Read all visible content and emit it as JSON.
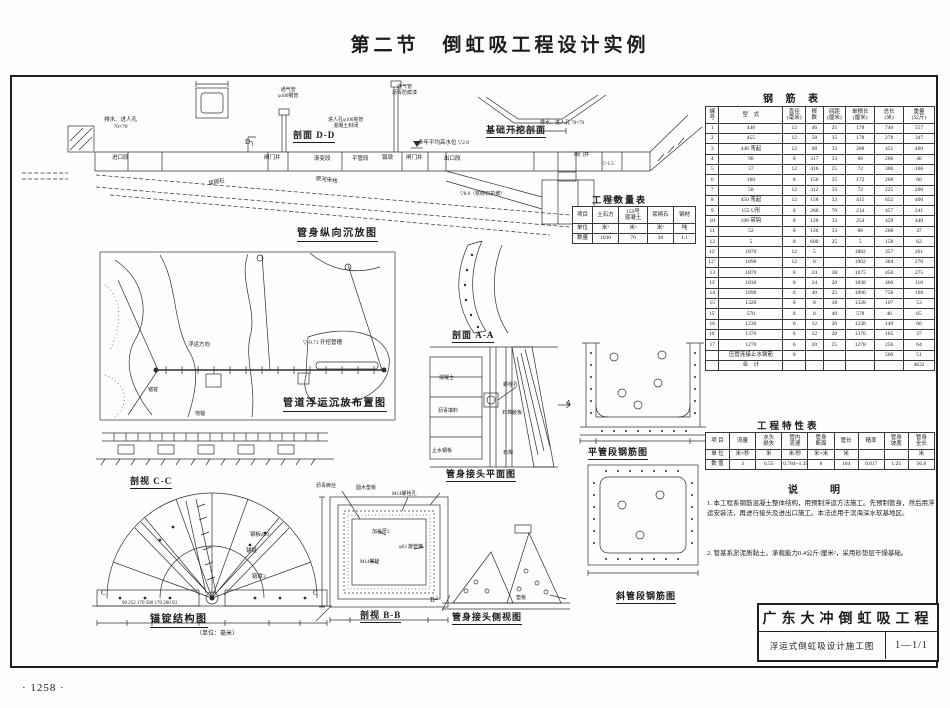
{
  "colors": {
    "ink": "#1c1c1c",
    "paper": "#fdfdfb"
  },
  "page": {
    "title": "第二节　倒虹吸工程设计实例",
    "page_number": "· 1258 ·"
  },
  "labels": {
    "d_arrow": "D┐",
    "a_arrow": "A",
    "b_arrow": "B┘",
    "section_dd_title": "剖面 D-D",
    "excavation_title": "基础开挖剖面",
    "profile_title": "管身纵向沉放图",
    "drain_manhole_left": "排水、进人孔\n70×70",
    "inlet": "进口段",
    "gate_well": "闸门井",
    "transition": "渐变段",
    "pipe_body": "平管段",
    "anchor_block": "镇墩",
    "gate_well2": "闸门井",
    "outlet": "出口段",
    "riverbed": "原河床线",
    "vent1": "通气管\nφ100钢管",
    "vent2": "通气管\n沥青防腐漆",
    "manhole_mid": "进人孔φ100夹管\n混凝土封闭",
    "water_level": "多年平均高水位 ▽2.8",
    "slope_note": "▽8.6（浆砌石护坡）",
    "masonry_slope": "浆砌石",
    "drain_manhole_right": "排水、进人孔 70×70",
    "outlet_well": "闸门井",
    "outlet_level": "▽-1.5",
    "weep_hole": "泄水孔",
    "map_title": "管道浮运沉放布置图",
    "map_channel": "▽-0.71 开挖管槽",
    "map_direction": "浮运方向",
    "map_anchor": "锚锭",
    "map_winch": "地锚",
    "cc_title": "剖视 C-C",
    "cc_left": "C",
    "cc_right": "C",
    "steel_plate": "钢板δ10",
    "anchor_chain": "锚链",
    "chain_thk": "链厚3",
    "cc_dims": "90   252   170      580      170   200   93",
    "anchor_title": "锚锭结构图",
    "anchor_unit": "（单位：毫米）",
    "bb_title": "剖视 B-B",
    "asphalt_fiber": "沥青麻丝",
    "wood_pad": "圆木垫板",
    "bolt_hole_bb": "M14螺栓孔",
    "cover_thk": "加盖厚3",
    "pipe_hoop": "φ63 旋管箍",
    "bolt_m14": "M14螺栓",
    "aa_title": "剖面 A-A",
    "concrete": "混凝土",
    "bolt_hole": "螺栓孔",
    "asphalt_seal": "沥青填料",
    "asbestos_board": "石棉嵌板",
    "water_stop": "止水钢板",
    "asbestos": "石棉",
    "joint_plan_title": "管身接头平面图",
    "joint_side_title": "管身接头侧视图",
    "pad_plate": "垫板",
    "flat_rebar_title": "平管段钢筋图",
    "incline_rebar_title": "斜管段钢筋图"
  },
  "quantity_table": {
    "title": "工程数量表",
    "rows": [
      [
        "项目",
        "土石方",
        "150号\n混凝土",
        "浆砌石",
        "钢材"
      ],
      [
        "单位",
        "米³",
        "米³",
        "米³",
        "吨"
      ],
      [
        "数量",
        "1030",
        "70",
        "30",
        "1.1"
      ]
    ]
  },
  "rebar_table": {
    "title": "钢 筋 表",
    "rows": [
      [
        "编\n号",
        "型　式",
        "直径\n(毫米)",
        "根\n数",
        "间距\n(厘米)",
        "单根长\n(厘米)",
        "总长\n(米)",
        "重量\n(公斤)"
      ],
      [
        "1",
        "448",
        "12",
        "46",
        "25",
        "178",
        "740",
        "557"
      ],
      [
        "2",
        "455",
        "12",
        "58",
        "35",
        "178",
        "278",
        "347"
      ],
      [
        "3",
        "448 弯起",
        "12",
        "68",
        "33",
        "288",
        "451",
        "400"
      ],
      [
        "4",
        "98",
        "8",
        "317",
        "33",
        "66",
        "206",
        "46"
      ],
      [
        "5",
        "57",
        "12",
        "416",
        "25",
        "72",
        "300",
        "166"
      ],
      [
        "6",
        "168",
        "8",
        "156",
        "25",
        "172",
        "268",
        "60"
      ],
      [
        "7",
        "58",
        "12",
        "312",
        "33",
        "72",
        "225",
        "200"
      ],
      [
        "8",
        "450 弯起",
        "12",
        "158",
        "33",
        "415",
        "652",
        "400"
      ],
      [
        "9",
        "155 U形",
        "8",
        "260",
        "70",
        "214",
        "457",
        "241"
      ],
      [
        "10",
        "198 带钩",
        "8",
        "128",
        "33",
        "254",
        "459",
        "440"
      ],
      [
        "11",
        "52",
        "8",
        "126",
        "33",
        "88",
        "268",
        "47"
      ],
      [
        "12",
        "5",
        "8",
        "600",
        "25",
        "5",
        "158",
        "62"
      ],
      [
        "12′",
        "1870",
        "12",
        "5",
        "",
        "1882",
        "357",
        "261"
      ],
      [
        "12″",
        "1890",
        "12",
        "6",
        "",
        "1902",
        "304",
        "270"
      ],
      [
        "13",
        "1870",
        "8",
        "24",
        "38",
        "1875",
        "450",
        "275"
      ],
      [
        "13′",
        "1830",
        "8",
        "24",
        "20",
        "1838",
        "460",
        "118"
      ],
      [
        "14",
        "1890",
        "6",
        "40",
        "25",
        "1896",
        "758",
        "168"
      ],
      [
        "15",
        "1320",
        "8",
        "8",
        "18",
        "1328",
        "107",
        "53"
      ],
      [
        "15′",
        "570",
        "8",
        "8",
        "40",
        "578",
        "46",
        "65"
      ],
      [
        "16",
        "1230",
        "6",
        "12",
        "20",
        "1238",
        "149",
        "66"
      ],
      [
        "16′",
        "1370",
        "6",
        "12",
        "20",
        "1376",
        "165",
        "37"
      ],
      [
        "17",
        "1270",
        "6",
        "20",
        "25",
        "1278",
        "256",
        "64"
      ],
      [
        "",
        "压管连接止水钢筋",
        "8",
        "",
        "",
        "",
        "500",
        "51"
      ],
      [
        "",
        "合　计",
        "",
        "",
        "",
        "",
        "",
        "4632"
      ]
    ]
  },
  "characteristics_table": {
    "title": "工程特性表",
    "rows": [
      [
        "项 目",
        "流量",
        "水头\n损失",
        "管内\n流速",
        "管身\n断面",
        "管长",
        "糙率",
        "管身\n坡度",
        "管身\n全长"
      ],
      [
        "单 位",
        "米³/秒",
        "米",
        "米/秒",
        "米×米",
        "米",
        "",
        "",
        "米"
      ],
      [
        "数 值",
        "3",
        "0.55",
        "0.784~1.35",
        "8",
        "104",
        "0.017",
        "1:25",
        "56.8"
      ]
    ]
  },
  "notes": {
    "title": "说　　明",
    "items": [
      "1. 本工程系钢筋混凝土整体结构，用预制浮运方法施工。先预制管身，然后用浮运安装法，再进行接头及进出口施工。本法适用于滨海深水软基地区。",
      "2. 管基系淤泥质黏土，承载能力0.4公斤/厘米²，采用砂垫层干燥基础。"
    ]
  },
  "title_block": {
    "project": "广东大冲倒虹吸工程",
    "drawing": "浮运式倒虹吸设计施工图",
    "sheet_no": "1—1/1"
  }
}
